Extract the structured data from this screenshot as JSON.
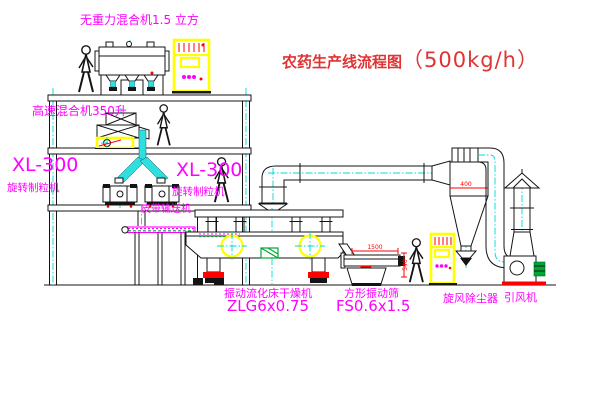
{
  "title": {
    "text": "农药生产线流程图",
    "capacity": "（500kg/h）"
  },
  "labels": {
    "weightless_mixer": "无重力混合机1.5 立方",
    "high_speed_mixer": "高速混合机350升",
    "granulator_left_model": "XL-300",
    "granulator_left_name": "旋转制粒机",
    "granulator_right_model": "XL-300",
    "granulator_right_name": "旋转制粒机",
    "belt_conveyor": "皮带输送机",
    "dryer_name": "振动流化床干燥机",
    "dryer_model": "ZLG6x0.75",
    "screen_name": "方形振动筛",
    "screen_model": "FS0.6x1.5",
    "cyclone": "旋风除尘器",
    "fan": "引风机"
  },
  "dimensions": {
    "screen_length": "1500",
    "screen_height": "540",
    "cyclone_band": "400"
  },
  "colors": {
    "label_magenta": "#ff00ff",
    "title_red": "#e03333",
    "centerline_cyan": "#00d8d8",
    "equipment_yellow": "#ffff00",
    "accent_red": "#ff0000",
    "accent_green": "#00a832",
    "line_black": "#141414"
  }
}
